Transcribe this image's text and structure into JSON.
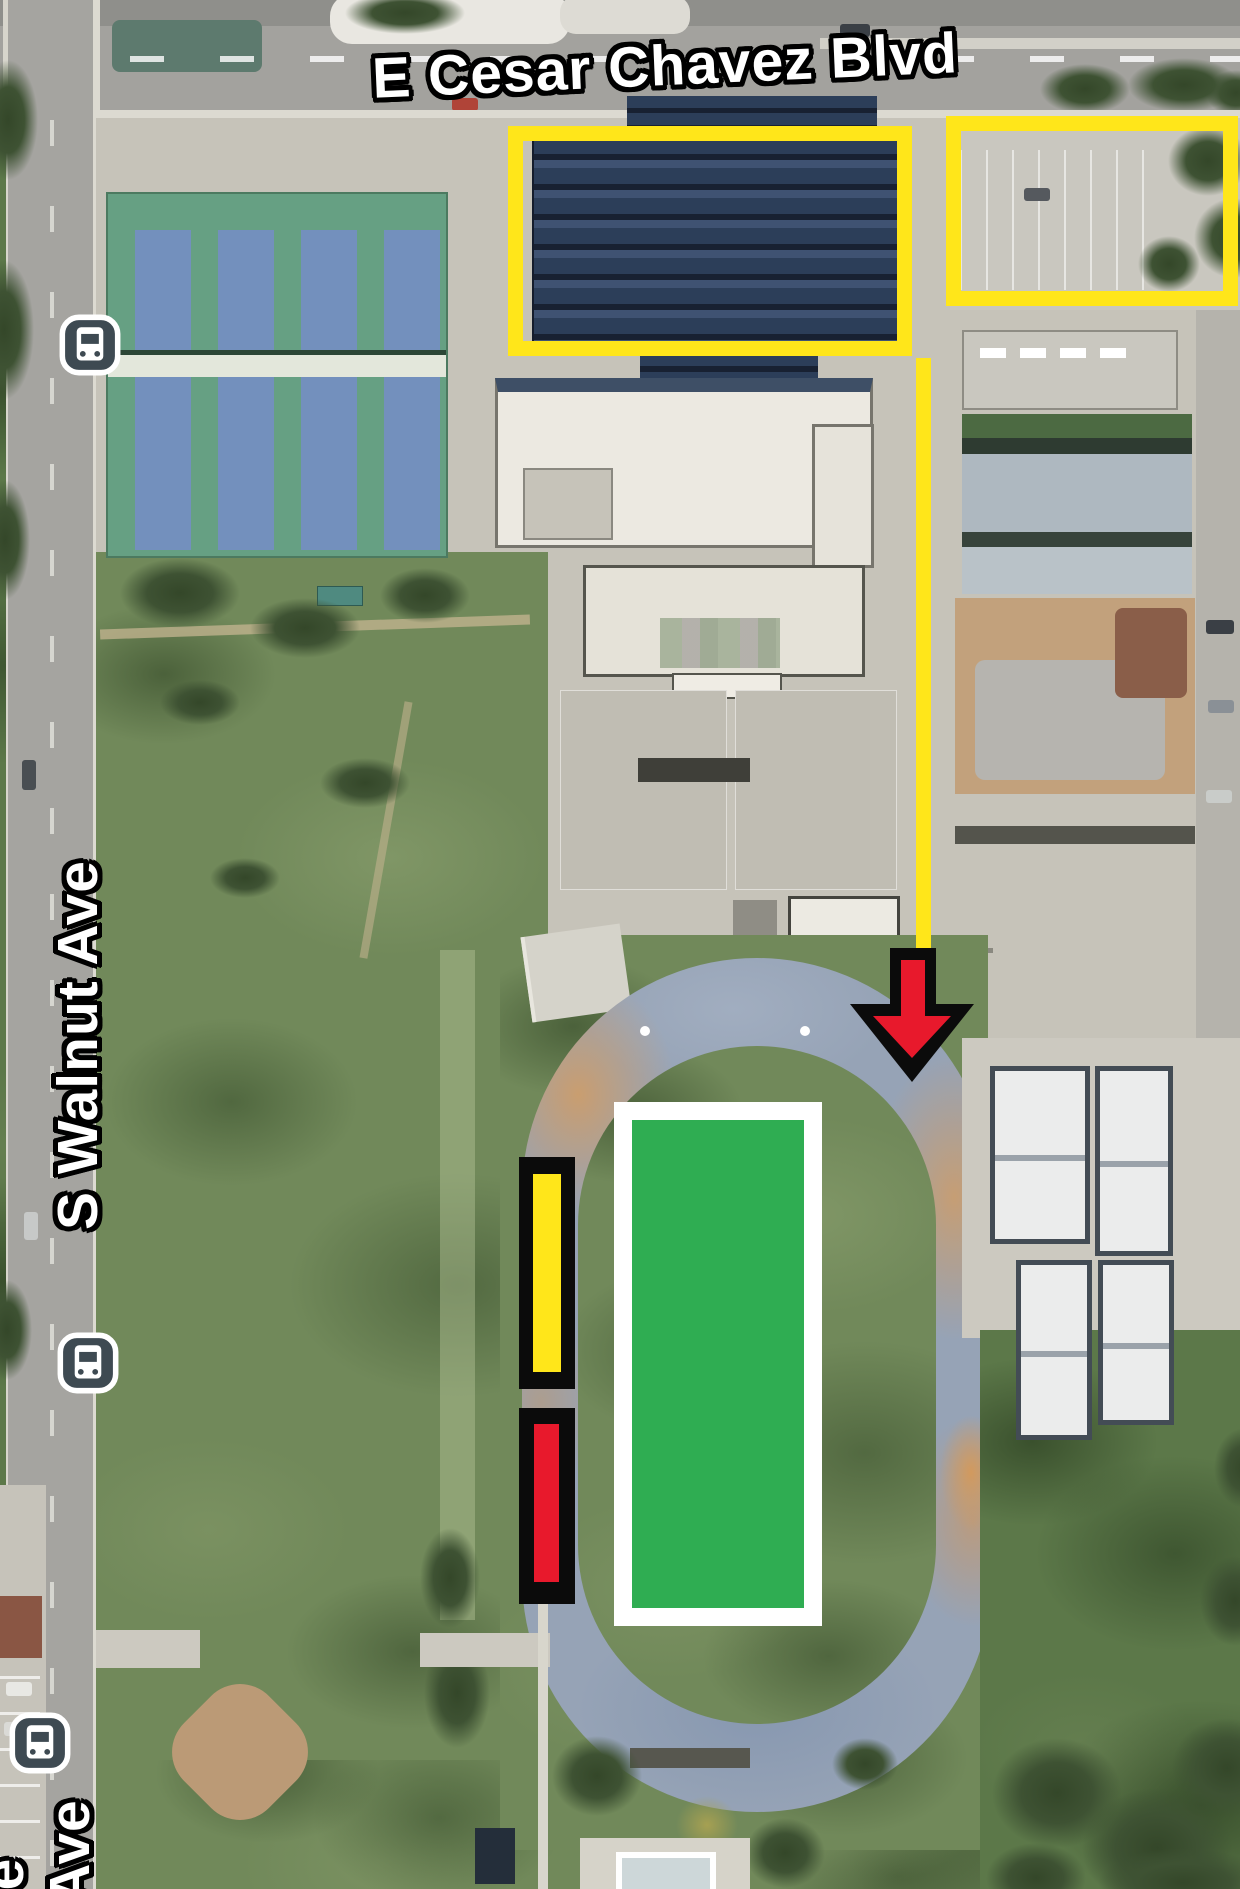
{
  "streets": {
    "top_label": "E Cesar Chavez Blvd",
    "left_label": "S Walnut Ave",
    "bottom_label": "Ave",
    "corner_partial_label": "e"
  },
  "icons": {
    "bus_stop": "bus-icon",
    "bus_stop_count": 3
  },
  "annotation_colors": {
    "highlight_yellow": "#ffe61a",
    "arrow_red": "#e8192c",
    "outline_black": "#0b0b0b"
  },
  "surface_colors": {
    "turf_green": "#2fad52",
    "track_gray_blue": "#96a3b6",
    "tennis_green": "#66a083",
    "tennis_court_blue": "#7390bd",
    "solar_canopy_navy": "#223350"
  }
}
